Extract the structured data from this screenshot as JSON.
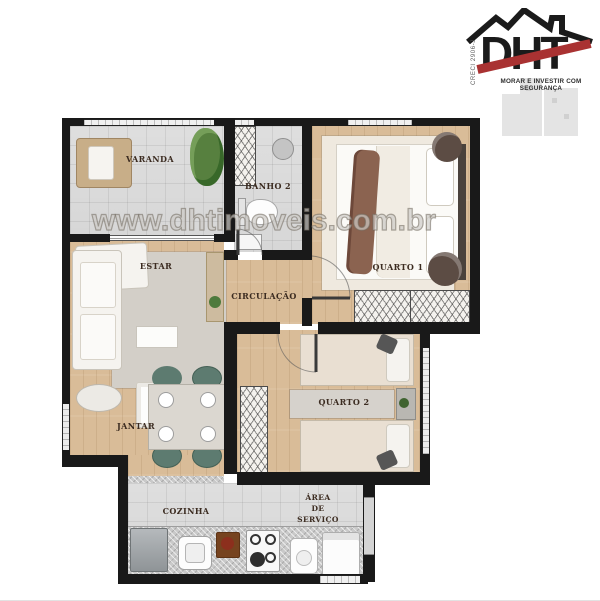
{
  "logo": {
    "brand": "DHT",
    "creci": "CRECI 2906-J",
    "tagline": "MORAR E INVESTIR COM SEGURANÇA"
  },
  "watermark": "www.dhtimoveis.com.br",
  "rooms": {
    "varanda": "VARANDA",
    "banho2": "BANHO 2",
    "quarto1": "QUARTO 1",
    "estar": "ESTAR",
    "circulacao": "CIRCULAÇÃO",
    "jantar": "JANTAR",
    "quarto2": "QUARTO 2",
    "cozinha": "COZINHA",
    "area_servico_l1": "ÁREA",
    "area_servico_l2": "DE",
    "area_servico_l3": "SERVIÇO"
  },
  "colors": {
    "wall": "#191919",
    "wood_floor": "#d9bc98",
    "tile_floor": "#d7d7d7",
    "logo_red": "#a93232",
    "chair_green": "#5d7b70",
    "label_ink": "#3b2b20"
  }
}
